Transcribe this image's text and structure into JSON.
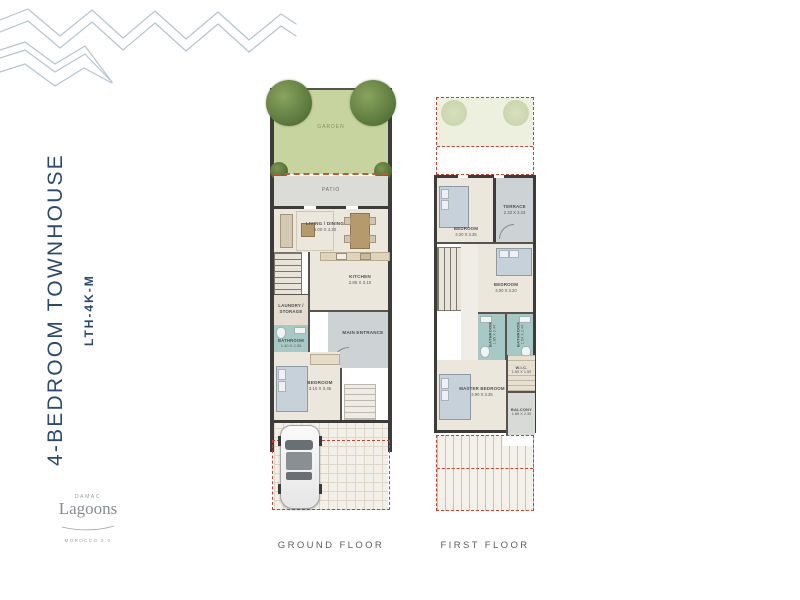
{
  "sidebar": {
    "title": "4-BEDROOM TOWNHOUSE",
    "code": "LTH-4K-M"
  },
  "logo": {
    "brand": "DAMAC",
    "name": "Lagoons",
    "tagline": "MOROCCO 2.0"
  },
  "ground_floor": {
    "caption": "GROUND FLOOR",
    "garden": {
      "label": "GARDEN"
    },
    "patio": {
      "label": "PATIO"
    },
    "living": {
      "label": "LIVING / DINING",
      "dims": "5.00 X 4.20"
    },
    "kitchen": {
      "label": "KITCHEN",
      "dims": "2.85 X 3.10"
    },
    "laundry": {
      "label": "LAUNDRY / STORAGE"
    },
    "bathroom": {
      "label": "BATHROOM",
      "dims": "1.40 X 2.35"
    },
    "entrance": {
      "label": "MAIN ENTRANCE"
    },
    "bedroom": {
      "label": "BEDROOM",
      "dims": "3.10 X 3.45"
    }
  },
  "first_floor": {
    "caption": "FIRST FLOOR",
    "bedroom_front": {
      "label": "BEDROOM",
      "dims": "3.20 X 3.35"
    },
    "terrace": {
      "label": "TERRACE",
      "dims": "2.33 X 3.33"
    },
    "bedroom_mid": {
      "label": "BEDROOM",
      "dims": "3.00 X 3.20"
    },
    "bathroom_a": {
      "label": "BATHROOM",
      "dims": "1.85 X 2.44"
    },
    "bathroom_b": {
      "label": "BATHROOM",
      "dims": "1.54 X 2.44"
    },
    "master": {
      "label": "MASTER BEDROOM",
      "dims": "3.90 X 3.35"
    },
    "wic": {
      "label": "W.I.C.",
      "dims": "1.60 X 1.50"
    },
    "balcony": {
      "label": "BALCONY",
      "dims": "1.85 X 2.30"
    }
  },
  "colors": {
    "title_navy": "#2b4a6d",
    "wall_dark": "#3e3c39",
    "floor_beige": "#ece7dd",
    "room_grey": "#cdd2d5",
    "bath_teal": "#a7c9c5",
    "garden_green": "#c8d4a0",
    "plot_dashed_red": "#c04434",
    "wave_blue": "#b7c4cd"
  }
}
